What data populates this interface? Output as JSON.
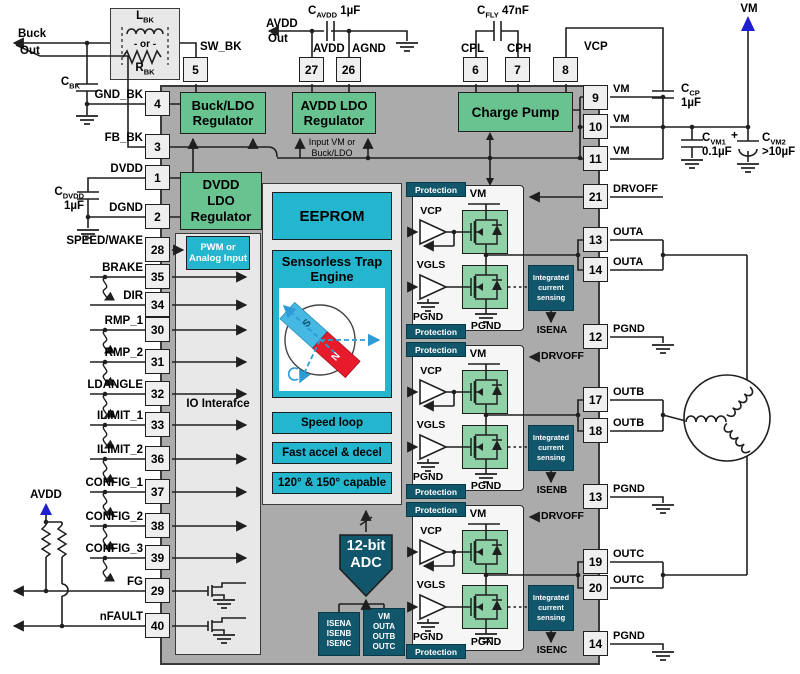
{
  "pins": {
    "top": [
      {
        "num": "5"
      },
      {
        "num": "27"
      },
      {
        "num": "26"
      },
      {
        "num": "6"
      },
      {
        "num": "7"
      },
      {
        "num": "8"
      }
    ],
    "left": [
      {
        "num": "4",
        "label": "GND_BK"
      },
      {
        "num": "3",
        "label": "FB_BK"
      },
      {
        "num": "1",
        "label": "DVDD"
      },
      {
        "num": "2",
        "label": "DGND"
      },
      {
        "num": "28",
        "label": "SPEED/WAKE"
      },
      {
        "num": "35",
        "label": "BRAKE"
      },
      {
        "num": "34",
        "label": "DIR"
      },
      {
        "num": "30",
        "label": "RMP_1"
      },
      {
        "num": "31",
        "label": "RMP_2"
      },
      {
        "num": "32",
        "label": "LDANGLE"
      },
      {
        "num": "33",
        "label": "ILIMIT_1"
      },
      {
        "num": "36",
        "label": "ILIMIT_2"
      },
      {
        "num": "37",
        "label": "CONFIG_1"
      },
      {
        "num": "38",
        "label": "CONFIG_2"
      },
      {
        "num": "39",
        "label": "CONFIG_3"
      },
      {
        "num": "29",
        "label": "FG"
      },
      {
        "num": "40",
        "label": "nFAULT"
      }
    ],
    "right": [
      {
        "num": "9",
        "label": "VM"
      },
      {
        "num": "10",
        "label": "VM"
      },
      {
        "num": "11",
        "label": "VM"
      },
      {
        "num": "21",
        "label": "DRVOFF"
      },
      {
        "num": "13",
        "label": "OUTA"
      },
      {
        "num": "14",
        "label": "OUTA"
      },
      {
        "num": "12",
        "label": "PGND"
      },
      {
        "num": "17",
        "label": "OUTB"
      },
      {
        "num": "18",
        "label": "OUTB"
      },
      {
        "num": "13",
        "label": "PGND"
      },
      {
        "num": "19",
        "label": "OUTC"
      },
      {
        "num": "20",
        "label": "OUTC"
      },
      {
        "num": "14",
        "label": "PGND"
      }
    ]
  },
  "buck": {
    "out1": "Buck",
    "out2": "Out",
    "l_main": "L",
    "l_sub": "BK",
    "or": "- or -",
    "r_main": "R",
    "r_sub": "BK",
    "sw": "SW_BK"
  },
  "caps": {
    "cbk": {
      "m": "C",
      "s": "BK"
    },
    "cdvdd": {
      "m": "C",
      "s": "DVDD",
      "v": "1µF"
    },
    "cavdd": {
      "m": "C",
      "s": "AVDD",
      "v": "1µF"
    },
    "cfly": {
      "m": "C",
      "s": "FLY",
      "v": "47nF"
    },
    "ccp": {
      "m": "C",
      "s": "CP",
      "v": "1µF"
    },
    "cvm1": {
      "m": "C",
      "s": "VM1",
      "v": "0.1µF"
    },
    "cvm2": {
      "m": "C",
      "s": "VM2",
      "v": ">10µF",
      "plus": "+"
    }
  },
  "nets": {
    "avdd_out1": "AVDD",
    "avdd_out2": "Out",
    "avdd": "AVDD",
    "agnd": "AGND",
    "cpl": "CPL",
    "cph": "CPH",
    "vcp": "VCP",
    "vm": "VM",
    "avdd_pull": "AVDD"
  },
  "blocks": {
    "buck_ldo1": "Buck/LDO",
    "buck_ldo2": "Regulator",
    "avdd_ldo1": "AVDD LDO",
    "avdd_ldo2": "Regulator",
    "charge_pump": "Charge Pump",
    "dvdd1": "DVDD",
    "dvdd2": "LDO",
    "dvdd3": "Regulator",
    "input1": "Input VM or",
    "input2": "Buck/LDO",
    "pwm1": "PWM or",
    "pwm2": "Analog Input",
    "io": "IO Interafce",
    "eeprom": "EEPROM",
    "trap1": "Sensorless Trap",
    "trap2": "Engine",
    "rotor_s": "S",
    "rotor_n": "N",
    "feat1": "Speed loop",
    "feat2": "Fast accel & decel",
    "feat3": "120° & 150° capable",
    "adc1": "12-bit",
    "adc2": "ADC",
    "sense1": "ISENA",
    "sense2": "ISENB",
    "sense3": "ISENC",
    "vout1": "VM",
    "vout2": "OUTA",
    "vout3": "OUTB",
    "vout4": "OUTC"
  },
  "drivers": [
    {
      "prot": "Protection",
      "vm": "VM",
      "vcp": "VCP",
      "vgls": "VGLS",
      "pgnd": "PGND",
      "ics1": "Integrated",
      "ics2": "current",
      "ics3": "sensing",
      "isen": "ISENA",
      "drvoff": "DRVOFF"
    },
    {
      "prot": "Protection",
      "vm": "VM",
      "vcp": "VCP",
      "vgls": "VGLS",
      "pgnd": "PGND",
      "ics1": "Integrated",
      "ics2": "current",
      "ics3": "sensing",
      "isen": "ISENB",
      "drvoff": "DRVOFF"
    },
    {
      "prot": "Protection",
      "vm": "VM",
      "vcp": "VCP",
      "vgls": "VGLS",
      "pgnd": "PGND",
      "ics1": "Integrated",
      "ics2": "current",
      "ics3": "sensing",
      "isen": "ISENC",
      "drvoff": "DRVOFF"
    }
  ]
}
